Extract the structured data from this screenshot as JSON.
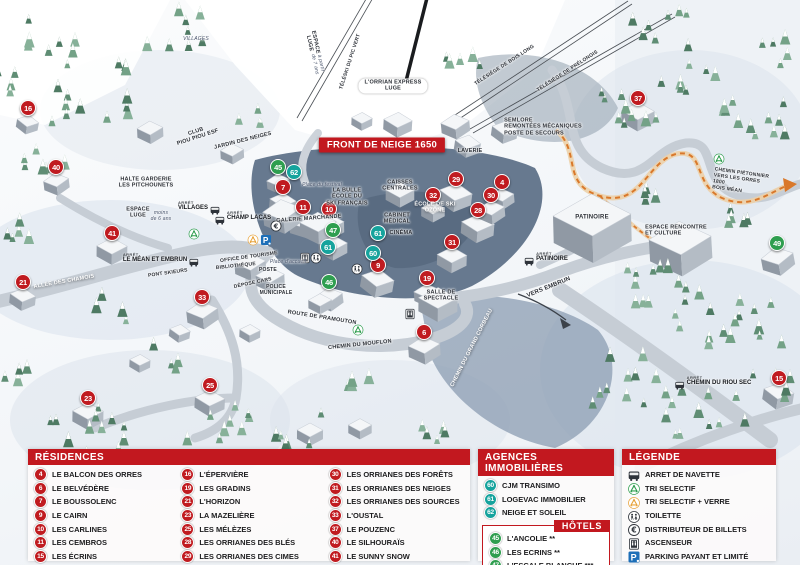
{
  "map": {
    "banner": "FRONT DE NEIGE 1650",
    "bus_stop_prefix": "ARRÊT",
    "markers": [
      {
        "n": "16",
        "x": 28,
        "y": 108,
        "c": "red"
      },
      {
        "n": "40",
        "x": 56,
        "y": 167,
        "c": "red"
      },
      {
        "n": "41",
        "x": 112,
        "y": 233,
        "c": "red"
      },
      {
        "n": "21",
        "x": 23,
        "y": 282,
        "c": "red"
      },
      {
        "n": "23",
        "x": 88,
        "y": 398,
        "c": "red"
      },
      {
        "n": "25",
        "x": 210,
        "y": 385,
        "c": "red"
      },
      {
        "n": "33",
        "x": 202,
        "y": 297,
        "c": "red"
      },
      {
        "n": "7",
        "x": 283,
        "y": 187,
        "c": "red"
      },
      {
        "n": "11",
        "x": 303,
        "y": 207,
        "c": "red"
      },
      {
        "n": "10",
        "x": 329,
        "y": 209,
        "c": "red"
      },
      {
        "n": "29",
        "x": 456,
        "y": 179,
        "c": "red"
      },
      {
        "n": "32",
        "x": 433,
        "y": 195,
        "c": "red"
      },
      {
        "n": "28",
        "x": 478,
        "y": 210,
        "c": "red"
      },
      {
        "n": "31",
        "x": 452,
        "y": 242,
        "c": "red"
      },
      {
        "n": "9",
        "x": 378,
        "y": 265,
        "c": "red"
      },
      {
        "n": "19",
        "x": 427,
        "y": 278,
        "c": "red"
      },
      {
        "n": "6",
        "x": 424,
        "y": 332,
        "c": "red"
      },
      {
        "n": "4",
        "x": 502,
        "y": 182,
        "c": "red"
      },
      {
        "n": "30",
        "x": 491,
        "y": 195,
        "c": "red"
      },
      {
        "n": "37",
        "x": 638,
        "y": 98,
        "c": "red"
      },
      {
        "n": "15",
        "x": 779,
        "y": 378,
        "c": "red"
      },
      {
        "n": "45",
        "x": 278,
        "y": 167,
        "c": "green"
      },
      {
        "n": "47",
        "x": 333,
        "y": 230,
        "c": "green"
      },
      {
        "n": "46",
        "x": 329,
        "y": 282,
        "c": "green"
      },
      {
        "n": "49",
        "x": 777,
        "y": 243,
        "c": "green"
      },
      {
        "n": "62",
        "x": 294,
        "y": 172,
        "c": "teal"
      },
      {
        "n": "61",
        "x": 328,
        "y": 247,
        "c": "teal"
      },
      {
        "n": "61",
        "x": 378,
        "y": 233,
        "c": "teal"
      },
      {
        "n": "60",
        "x": 373,
        "y": 253,
        "c": "teal"
      }
    ],
    "labels": [
      {
        "t": "HALTE GARDERIE\nLES PITCHOUNETS",
        "x": 146,
        "y": 183,
        "fs": 5.5
      },
      {
        "t": "CLUB\nPIOU PIOU ESF",
        "x": 197,
        "y": 135,
        "r": -18,
        "fs": 5.5
      },
      {
        "t": "JARDIN DES NEIGES",
        "x": 243,
        "y": 141,
        "r": -14,
        "fs": 5.5
      },
      {
        "t": "ESPACE\nLUGE",
        "x": 138,
        "y": 213,
        "fs": 5.5
      },
      {
        "t": "moins\nde 6 ans",
        "x": 161,
        "y": 217,
        "st": "i",
        "fs": 5
      },
      {
        "t": "ESPACE\nLUGE",
        "x": 312,
        "y": 43,
        "r": 78,
        "fs": 5.5
      },
      {
        "t": "à partir\nde 7 ans",
        "x": 317,
        "y": 64,
        "r": 78,
        "st": "i",
        "fs": 5
      },
      {
        "t": "TÉLÉSKI DU PIC VERT",
        "x": 351,
        "y": 62,
        "r": -72,
        "fs": 5
      },
      {
        "t": "L'ORRIAN EXPRESS\nLUGE",
        "x": 393,
        "y": 86,
        "st": "pill",
        "fs": 5.5
      },
      {
        "t": "TÉLÉSIÈGE DE BOIS LONG",
        "x": 505,
        "y": 66,
        "r": -33,
        "fs": 5
      },
      {
        "t": "TÉLÉSIÈGE DE PRÉLONGIS",
        "x": 568,
        "y": 72,
        "r": -33,
        "fs": 5
      },
      {
        "t": "SEMLORE\nREMONTÉES MÉCANIQUES\nPOSTE DE SECOURS",
        "x": 543,
        "y": 127,
        "st": "left",
        "fs": 5.5
      },
      {
        "t": "LAVERIE",
        "x": 470,
        "y": 151,
        "fs": 5.5
      },
      {
        "t": "CAISSES\nCENTRALES",
        "x": 400,
        "y": 186,
        "fs": 5.5
      },
      {
        "t": "ÉCOLE DE SKI\nOZONE",
        "x": 435,
        "y": 208,
        "st": "w",
        "fs": 5.5
      },
      {
        "t": "CABINET\nMÉDICAL",
        "x": 397,
        "y": 219,
        "fs": 5.5
      },
      {
        "t": "CINÉMA",
        "x": 401,
        "y": 233,
        "fs": 5.5
      },
      {
        "t": "LA BULLE\nÉCOLE DU\nSKI FRANÇAIS",
        "x": 347,
        "y": 197,
        "fs": 5.5
      },
      {
        "t": "Place du festival",
        "x": 322,
        "y": 186,
        "st": "i",
        "fs": 5
      },
      {
        "t": "GALERIE MARCHANDE",
        "x": 309,
        "y": 219,
        "r": -4,
        "fs": 5.5
      },
      {
        "t": "OFFICE DE TOURISME",
        "x": 249,
        "y": 258,
        "r": -8,
        "fs": 5
      },
      {
        "t": "BIBLIOTHÈQUE",
        "x": 236,
        "y": 267,
        "r": -6,
        "fs": 5
      },
      {
        "t": "POSTE",
        "x": 268,
        "y": 271,
        "fs": 5
      },
      {
        "t": "DÉPOSE CARS",
        "x": 253,
        "y": 284,
        "r": -12,
        "fs": 5
      },
      {
        "t": "POLICE\nMUNICIPALE",
        "x": 276,
        "y": 291,
        "fs": 5
      },
      {
        "t": "Place d'accueil",
        "x": 288,
        "y": 263,
        "st": "i",
        "fs": 5
      },
      {
        "t": "PONT SKIEURS",
        "x": 168,
        "y": 274,
        "r": -8,
        "fs": 5
      },
      {
        "t": "ALLÉE DES CHAMOIS",
        "x": 64,
        "y": 282,
        "r": -10,
        "st": "w",
        "fs": 5.5
      },
      {
        "t": "ROUTE DE PRAMOUTON",
        "x": 322,
        "y": 318,
        "r": 9,
        "fs": 5.5
      },
      {
        "t": "CHEMIN DU MOUFLON",
        "x": 360,
        "y": 345,
        "r": -6,
        "fs": 5.5
      },
      {
        "t": "CHEMIN DU GRAND CORBEAU",
        "x": 472,
        "y": 348,
        "r": -63,
        "st": "w",
        "fs": 5.5
      },
      {
        "t": "VERS EMBRUN",
        "x": 549,
        "y": 288,
        "r": -22,
        "fs": 6
      },
      {
        "t": "PATINOIRE",
        "x": 592,
        "y": 218,
        "fs": 6
      },
      {
        "t": "ESPACE RENCONTRE\nET CULTURE",
        "x": 676,
        "y": 231,
        "st": "left",
        "fs": 5.5
      },
      {
        "t": "CHEMIN PIÉTONNIER\nVERS LES ORRES 1800\nBOIS MÉAN",
        "x": 742,
        "y": 183,
        "r": 8,
        "st": "left",
        "fs": 5
      },
      {
        "t": "SALLE DE\nSPECTACLE",
        "x": 441,
        "y": 296,
        "fs": 5.5
      },
      {
        "t": "VILLAGES",
        "x": 196,
        "y": 40,
        "st": "i",
        "fs": 5
      }
    ],
    "bus_stops": [
      {
        "name": "VILLAGES",
        "x": 199,
        "y": 206,
        "side": "right"
      },
      {
        "name": "CHAMP LACAS",
        "x": 243,
        "y": 216,
        "side": "left"
      },
      {
        "name": "LE MÉAN ET EMBRUN",
        "x": 161,
        "y": 258,
        "side": "right"
      },
      {
        "name": "PATINOIRE",
        "x": 546,
        "y": 257,
        "side": "left"
      },
      {
        "name": "CHEMIN DU RIOU SEC",
        "x": 713,
        "y": 381,
        "side": "left"
      }
    ],
    "icons": [
      {
        "type": "recycle-green",
        "x": 194,
        "y": 232
      },
      {
        "type": "recycle-green",
        "x": 358,
        "y": 328
      },
      {
        "type": "recycle-green",
        "x": 719,
        "y": 157
      },
      {
        "type": "recycle-yellow",
        "x": 253,
        "y": 238
      },
      {
        "type": "parking",
        "x": 266,
        "y": 238
      },
      {
        "type": "euro",
        "x": 276,
        "y": 224
      },
      {
        "type": "elevator",
        "x": 305,
        "y": 256
      },
      {
        "type": "toilet",
        "x": 316,
        "y": 256
      },
      {
        "type": "toilet",
        "x": 357,
        "y": 267
      },
      {
        "type": "elevator",
        "x": 410,
        "y": 312
      }
    ]
  },
  "legend": {
    "residences": {
      "title": "RÉSIDENCES",
      "items": [
        {
          "n": "4",
          "label": "LE BALCON DES ORRES"
        },
        {
          "n": "6",
          "label": "LE BELVÉDÈRE"
        },
        {
          "n": "7",
          "label": "LE BOUSSOLENC"
        },
        {
          "n": "9",
          "label": "LE CAIRN"
        },
        {
          "n": "10",
          "label": "LES CARLINES"
        },
        {
          "n": "11",
          "label": "LES CEMBROS"
        },
        {
          "n": "15",
          "label": "LES ÉCRINS"
        },
        {
          "n": "16",
          "label": "L'ÉPERVIÈRE"
        },
        {
          "n": "19",
          "label": "LES GRADINS"
        },
        {
          "n": "21",
          "label": "L'HORIZON"
        },
        {
          "n": "23",
          "label": "LA MAZELIÈRE"
        },
        {
          "n": "25",
          "label": "LES MÉLÈZES"
        },
        {
          "n": "28",
          "label": "LES ORRIANES DES BLÉS"
        },
        {
          "n": "29",
          "label": "LES ORRIANES DES CIMES"
        },
        {
          "n": "30",
          "label": "LES ORRIANES DES FORÊTS"
        },
        {
          "n": "31",
          "label": "LES ORRIANES DES NEIGES"
        },
        {
          "n": "32",
          "label": "LES ORRIANES DES SOURCES"
        },
        {
          "n": "33",
          "label": "L'OUSTAL"
        },
        {
          "n": "37",
          "label": "LE POUZENC"
        },
        {
          "n": "40",
          "label": "LE SILHOURAÏS"
        },
        {
          "n": "41",
          "label": "LE SUNNY SNOW"
        }
      ]
    },
    "agences": {
      "title": "AGENCES IMMOBILIÈRES",
      "items": [
        {
          "n": "60",
          "label": "CJM TRANSIMO"
        },
        {
          "n": "61",
          "label": "LOGEVAC IMMOBILIER"
        },
        {
          "n": "62",
          "label": "NEIGE ET SOLEIL"
        }
      ]
    },
    "hotels": {
      "title": "HÔTELS",
      "items": [
        {
          "n": "45",
          "label": "L'ANCOLIE **"
        },
        {
          "n": "46",
          "label": "LES ECRINS **"
        },
        {
          "n": "47",
          "label": "L'ESCALE BLANCHE ***"
        },
        {
          "n": "49",
          "label": "LES TRAPPEURS **"
        }
      ]
    },
    "legende": {
      "title": "LÉGENDE",
      "items": [
        {
          "icon": "bus",
          "label": "ARRET DE NAVETTE"
        },
        {
          "icon": "recycle-green",
          "label": "TRI SELECTIF"
        },
        {
          "icon": "recycle-yellow",
          "label": "TRI SELECTIF + VERRE"
        },
        {
          "icon": "toilet",
          "label": "TOILETTE"
        },
        {
          "icon": "euro",
          "label": "DISTRIBUTEUR DE BILLETS"
        },
        {
          "icon": "elevator",
          "label": "ASCENSEUR"
        },
        {
          "icon": "parking",
          "label": "PARKING PAYANT ET LIMITÉ"
        }
      ]
    }
  },
  "colors": {
    "red": "#c01b20",
    "header_red": "#c2181f",
    "green": "#2f9e4f",
    "teal": "#16a39d",
    "orange_path": "#d9782a",
    "parking_blue": "#1d6fb8"
  }
}
